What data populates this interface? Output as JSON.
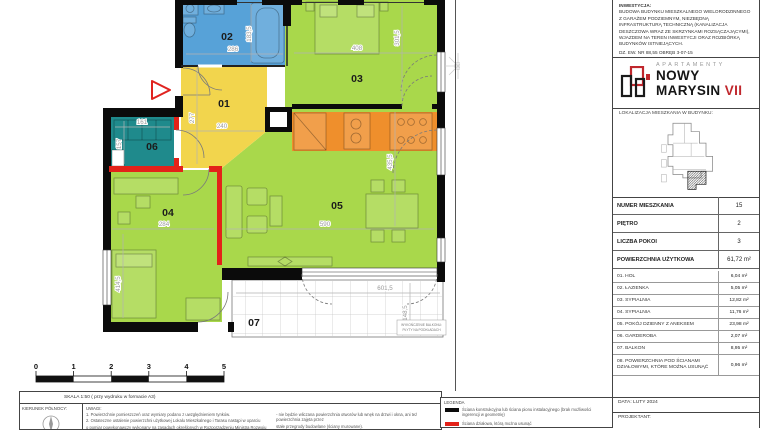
{
  "plan": {
    "labels": {
      "r01": "01",
      "r02": "02",
      "r03": "03",
      "r04": "04",
      "r05": "05",
      "r06": "06",
      "r07": "07"
    },
    "dims": {
      "w02": "286",
      "h02": "183,5",
      "w03": "408",
      "h03": "301,5",
      "w01": "240",
      "h01": "277",
      "w06": "161",
      "h06": "157",
      "w04": "284",
      "h04": "414,5",
      "w05": "590",
      "h05": "435,5",
      "w07": "601,5",
      "h07": "148,5"
    },
    "balcony_note_1": "WYKOŃCZENIE BALKONU:",
    "balcony_note_2": "PŁYTY NA PODKŁADACH"
  },
  "title_block": {
    "investment": [
      "INWESTYCJA:",
      "BUDOWA BUDYNKU MIESZKALNEGO WIELORODZINNEGO",
      "Z GARAŻEM PODZIEMNYM, NIEZBĘDNĄ",
      "INFRASTRUKTURĄ TECHNICZNĄ (KANALIZACJA",
      "DESZCZOWA WRAZ ZE SKRZYNKAMI ROZSĄCZAJĄCYMI),",
      "WJAZDEM NA TEREN INWESTYCJI ORAZ ROZBIÓRKĄ",
      "BUDYNKÓW ISTNIEJĄCYCH.",
      "DZ. EW. NR 88,55 OBRĘB 3-07-15"
    ],
    "logo": {
      "apartamenty": "APARTAMENTY",
      "name": "NOWY MARYSIN",
      "roman": "VII"
    },
    "location_label": "LOKALIZACJA MIESZKANIA W BUDYNKU:",
    "info_table": [
      {
        "label": "NUMER MIESZKANIA",
        "value": "15"
      },
      {
        "label": "PIĘTRO",
        "value": "2"
      },
      {
        "label": "LICZBA POKOI",
        "value": "3"
      },
      {
        "label": "POWIERZCHNIA UŻYTKOWA",
        "value": "61,72 m²"
      }
    ],
    "rooms_table": [
      {
        "name": "01. HOL",
        "area": "6,04 m²"
      },
      {
        "name": "02. ŁAZIENKA",
        "area": "5,05 m²"
      },
      {
        "name": "03. SYPIALNIA",
        "area": "12,82 m²"
      },
      {
        "name": "04. SYPIALNIA",
        "area": "11,76 m²"
      },
      {
        "name": "05. POKÓJ DZIENNY Z ANEKSEM",
        "area": "23,98 m²"
      },
      {
        "name": "06. GARDEROBA",
        "area": "2,07 m²"
      },
      {
        "name": "07. BALKON",
        "area": "8,95 m²"
      },
      {
        "name": "08. POWIERZCHNIA POD ŚCIANAMI DZIAŁOWYMI, KTÓRE MOŻNA USUNĄĆ",
        "area": "0,96 m²"
      }
    ],
    "date_label": "DATA:  LUTY 2024",
    "designer_label": "PROJEKTANT:"
  },
  "footer": {
    "scale_note": "SKALA 1:50 ( przy wydruku w formacie A3)",
    "north_label": "KIERUNEK PÓŁNOCY:",
    "uwagi_title": "UWAGI:",
    "notes_col1": [
      "1. Powierzchnie pomieszczeń oraz wymiary podano z uwzględnieniem tynków.",
      "2. Ostateczne ustalenie powierzchni użytkowej Lokalu Mieszkalnego i Tarasu nastąpi w oparciu",
      "o pomiar powykonawczy wykonany na zasadach określonych w Rozporządzeniu Ministra Rozwoju"
    ],
    "notes_col2": [
      "- nie będzie wliczana powierzchnia otworów lub wnęk na drzwi i okna, ani też powierzchnia zajęta przez",
      "stałe przegrody budowlane (ściany murowane).",
      "3. Rysunek opracowano na podstawie projektu wykonawczego."
    ],
    "legend_title": "LEGENDA",
    "legend_items": [
      {
        "text": "Ściana konstrukcyjna lub ściana pionu instalacyjnego (brak możliwości ingerencji w geometrię)"
      },
      {
        "text": "Ściana działowa, którą można usunąć"
      }
    ]
  },
  "scale_bar": {
    "ticks": [
      "0",
      "1",
      "2",
      "3",
      "4",
      "5"
    ]
  },
  "colors": {
    "room_green": "#a9d84b",
    "room_blue": "#57a2d8",
    "room_yellow": "#f2d54d",
    "room_orange": "#ef8f2c",
    "room_teal": "#1f8a8c",
    "removable_wall_red": "#e32219",
    "wall_black": "#0b0b0b",
    "logo_red": "#c0272d"
  }
}
